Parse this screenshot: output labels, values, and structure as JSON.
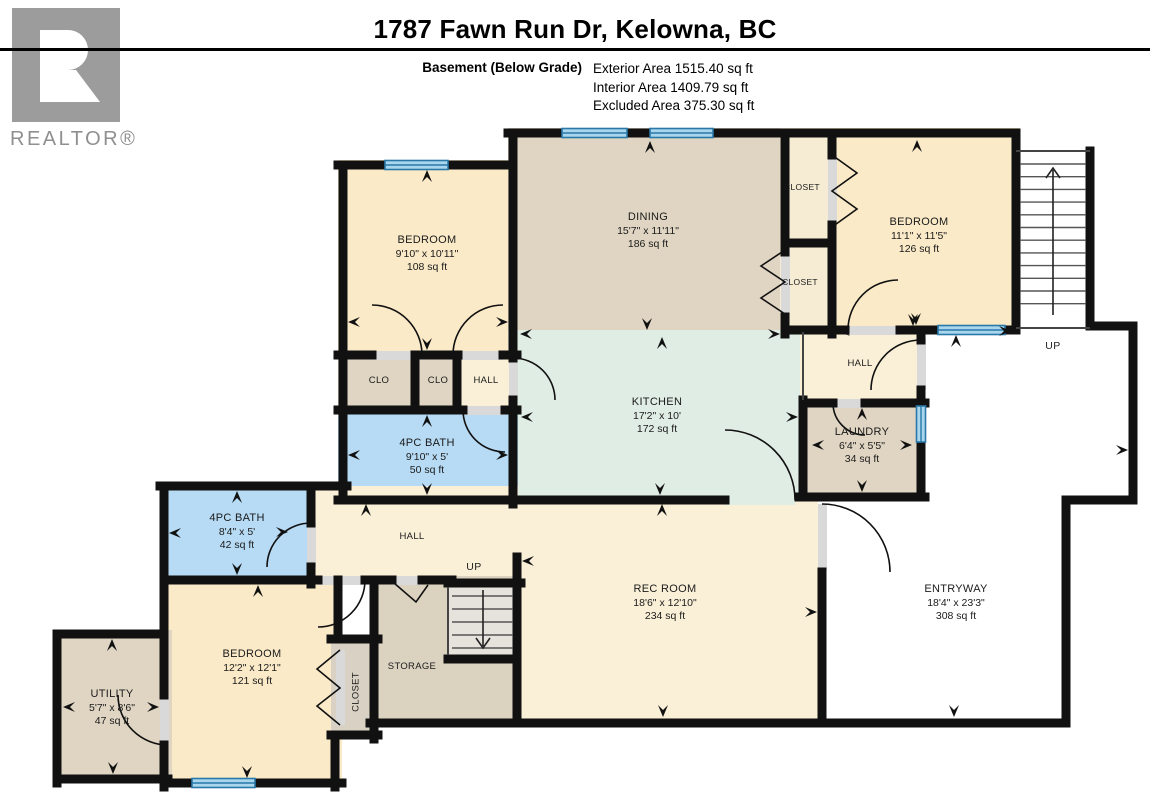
{
  "header": {
    "title": "1787 Fawn Run Dr, Kelowna, BC",
    "floor_label": "Basement (Below Grade)",
    "stats": [
      "Exterior Area 1515.40 sq ft",
      "Interior Area 1409.79 sq ft",
      "Excluded Area 375.30 sq ft"
    ]
  },
  "logo": {
    "brand": "REALTOR®"
  },
  "stairs": {
    "upper_label": "UP",
    "lower_label": "UP"
  },
  "rooms": [
    {
      "id": "bedroom-upper-left",
      "name": "BEDROOM",
      "dims": "9'10\" x 10'11\"",
      "area": "108 sq ft"
    },
    {
      "id": "dining",
      "name": "DINING",
      "dims": "15'7\" x 11'11\"",
      "area": "186 sq ft"
    },
    {
      "id": "closet-top",
      "name": "CLOSET",
      "dims": "",
      "area": ""
    },
    {
      "id": "closet-mid",
      "name": "CLOSET",
      "dims": "",
      "area": ""
    },
    {
      "id": "bedroom-upper-right",
      "name": "BEDROOM",
      "dims": "11'1\" x 11'5\"",
      "area": "126 sq ft"
    },
    {
      "id": "clo-a",
      "name": "CLO",
      "dims": "",
      "area": ""
    },
    {
      "id": "clo-b",
      "name": "CLO",
      "dims": "",
      "area": ""
    },
    {
      "id": "hall-small",
      "name": "HALL",
      "dims": "",
      "area": ""
    },
    {
      "id": "kitchen",
      "name": "KITCHEN",
      "dims": "17'2\" x 10'",
      "area": "172 sq ft"
    },
    {
      "id": "hall-upper",
      "name": "HALL",
      "dims": "",
      "area": ""
    },
    {
      "id": "laundry",
      "name": "LAUNDRY",
      "dims": "6'4\" x 5'5\"",
      "area": "34 sq ft"
    },
    {
      "id": "bath-upper",
      "name": "4PC BATH",
      "dims": "9'10\" x 5'",
      "area": "50 sq ft"
    },
    {
      "id": "bath-lower",
      "name": "4PC BATH",
      "dims": "8'4\" x 5'",
      "area": "42 sq ft"
    },
    {
      "id": "hall-main",
      "name": "HALL",
      "dims": "",
      "area": ""
    },
    {
      "id": "rec-room",
      "name": "REC ROOM",
      "dims": "18'6\" x 12'10\"",
      "area": "234 sq ft"
    },
    {
      "id": "entryway",
      "name": "ENTRYWAY",
      "dims": "18'4\" x 23'3\"",
      "area": "308 sq ft"
    },
    {
      "id": "bedroom-lower",
      "name": "BEDROOM",
      "dims": "12'2\" x 12'1\"",
      "area": "121 sq ft"
    },
    {
      "id": "utility",
      "name": "UTILITY",
      "dims": "5'7\" x 8'6\"",
      "area": "47 sq ft"
    },
    {
      "id": "closet-lower",
      "name": "CLOSET",
      "dims": "",
      "area": ""
    },
    {
      "id": "storage",
      "name": "STORAGE",
      "dims": "",
      "area": ""
    }
  ],
  "colors": {
    "room_cream": "#FAEAC8",
    "room_tan": "#DFD5C2",
    "room_mint": "#E0EDE4",
    "room_bath_blue": "#B7DBF4",
    "window_blue": "#A9D6EC",
    "window_frame": "#2878A8",
    "wall": "#111111",
    "logo_gray": "#9C9C9C"
  }
}
